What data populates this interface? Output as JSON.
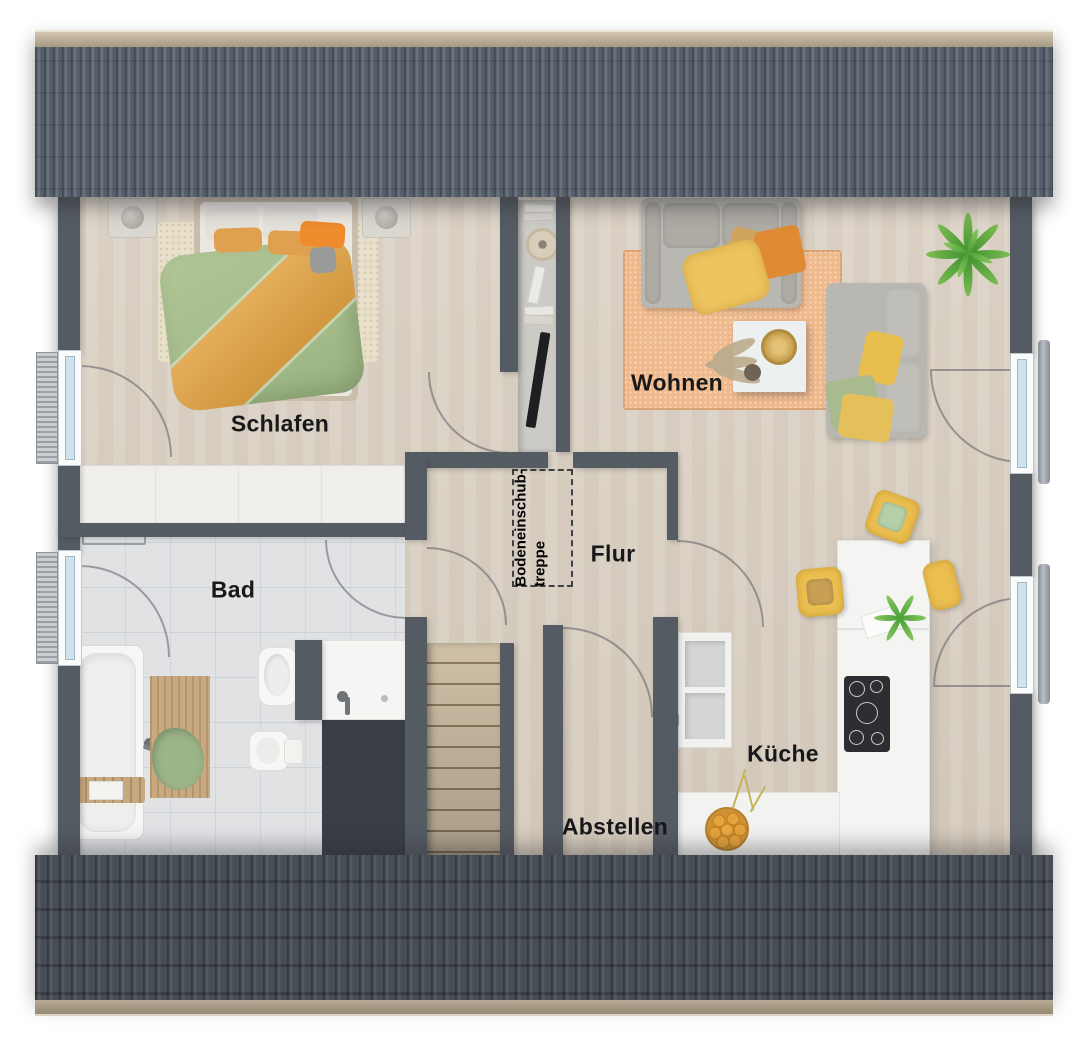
{
  "rooms": {
    "bedroom": "Schlafen",
    "living": "Wohnen",
    "bath": "Bad",
    "hall": "Flur",
    "kitchen": "Küche",
    "storage": "Abstellen",
    "attic_line1": "Bodeneinschub-",
    "attic_line2": "treppe"
  },
  "colors": {
    "roof_top": "#59626f",
    "roof_ridge": "#b9ac97",
    "roof_bottom": "#474d55",
    "gutter": "#b7aa96",
    "wall": "#555b63",
    "wood_floor": "#d9d0c4",
    "tile_floor": "#e0e2e4",
    "rug_bedroom": "#e9e0cb",
    "rug_living": "#efb98c",
    "duvet_green": "#a9c08f",
    "duvet_orange": "#dda44f",
    "sofa_gray": "#b9b7b2",
    "chair_yellow": "#eabf50",
    "plant_green": "#5aa33c",
    "stairs_wood": "#c4b193"
  }
}
